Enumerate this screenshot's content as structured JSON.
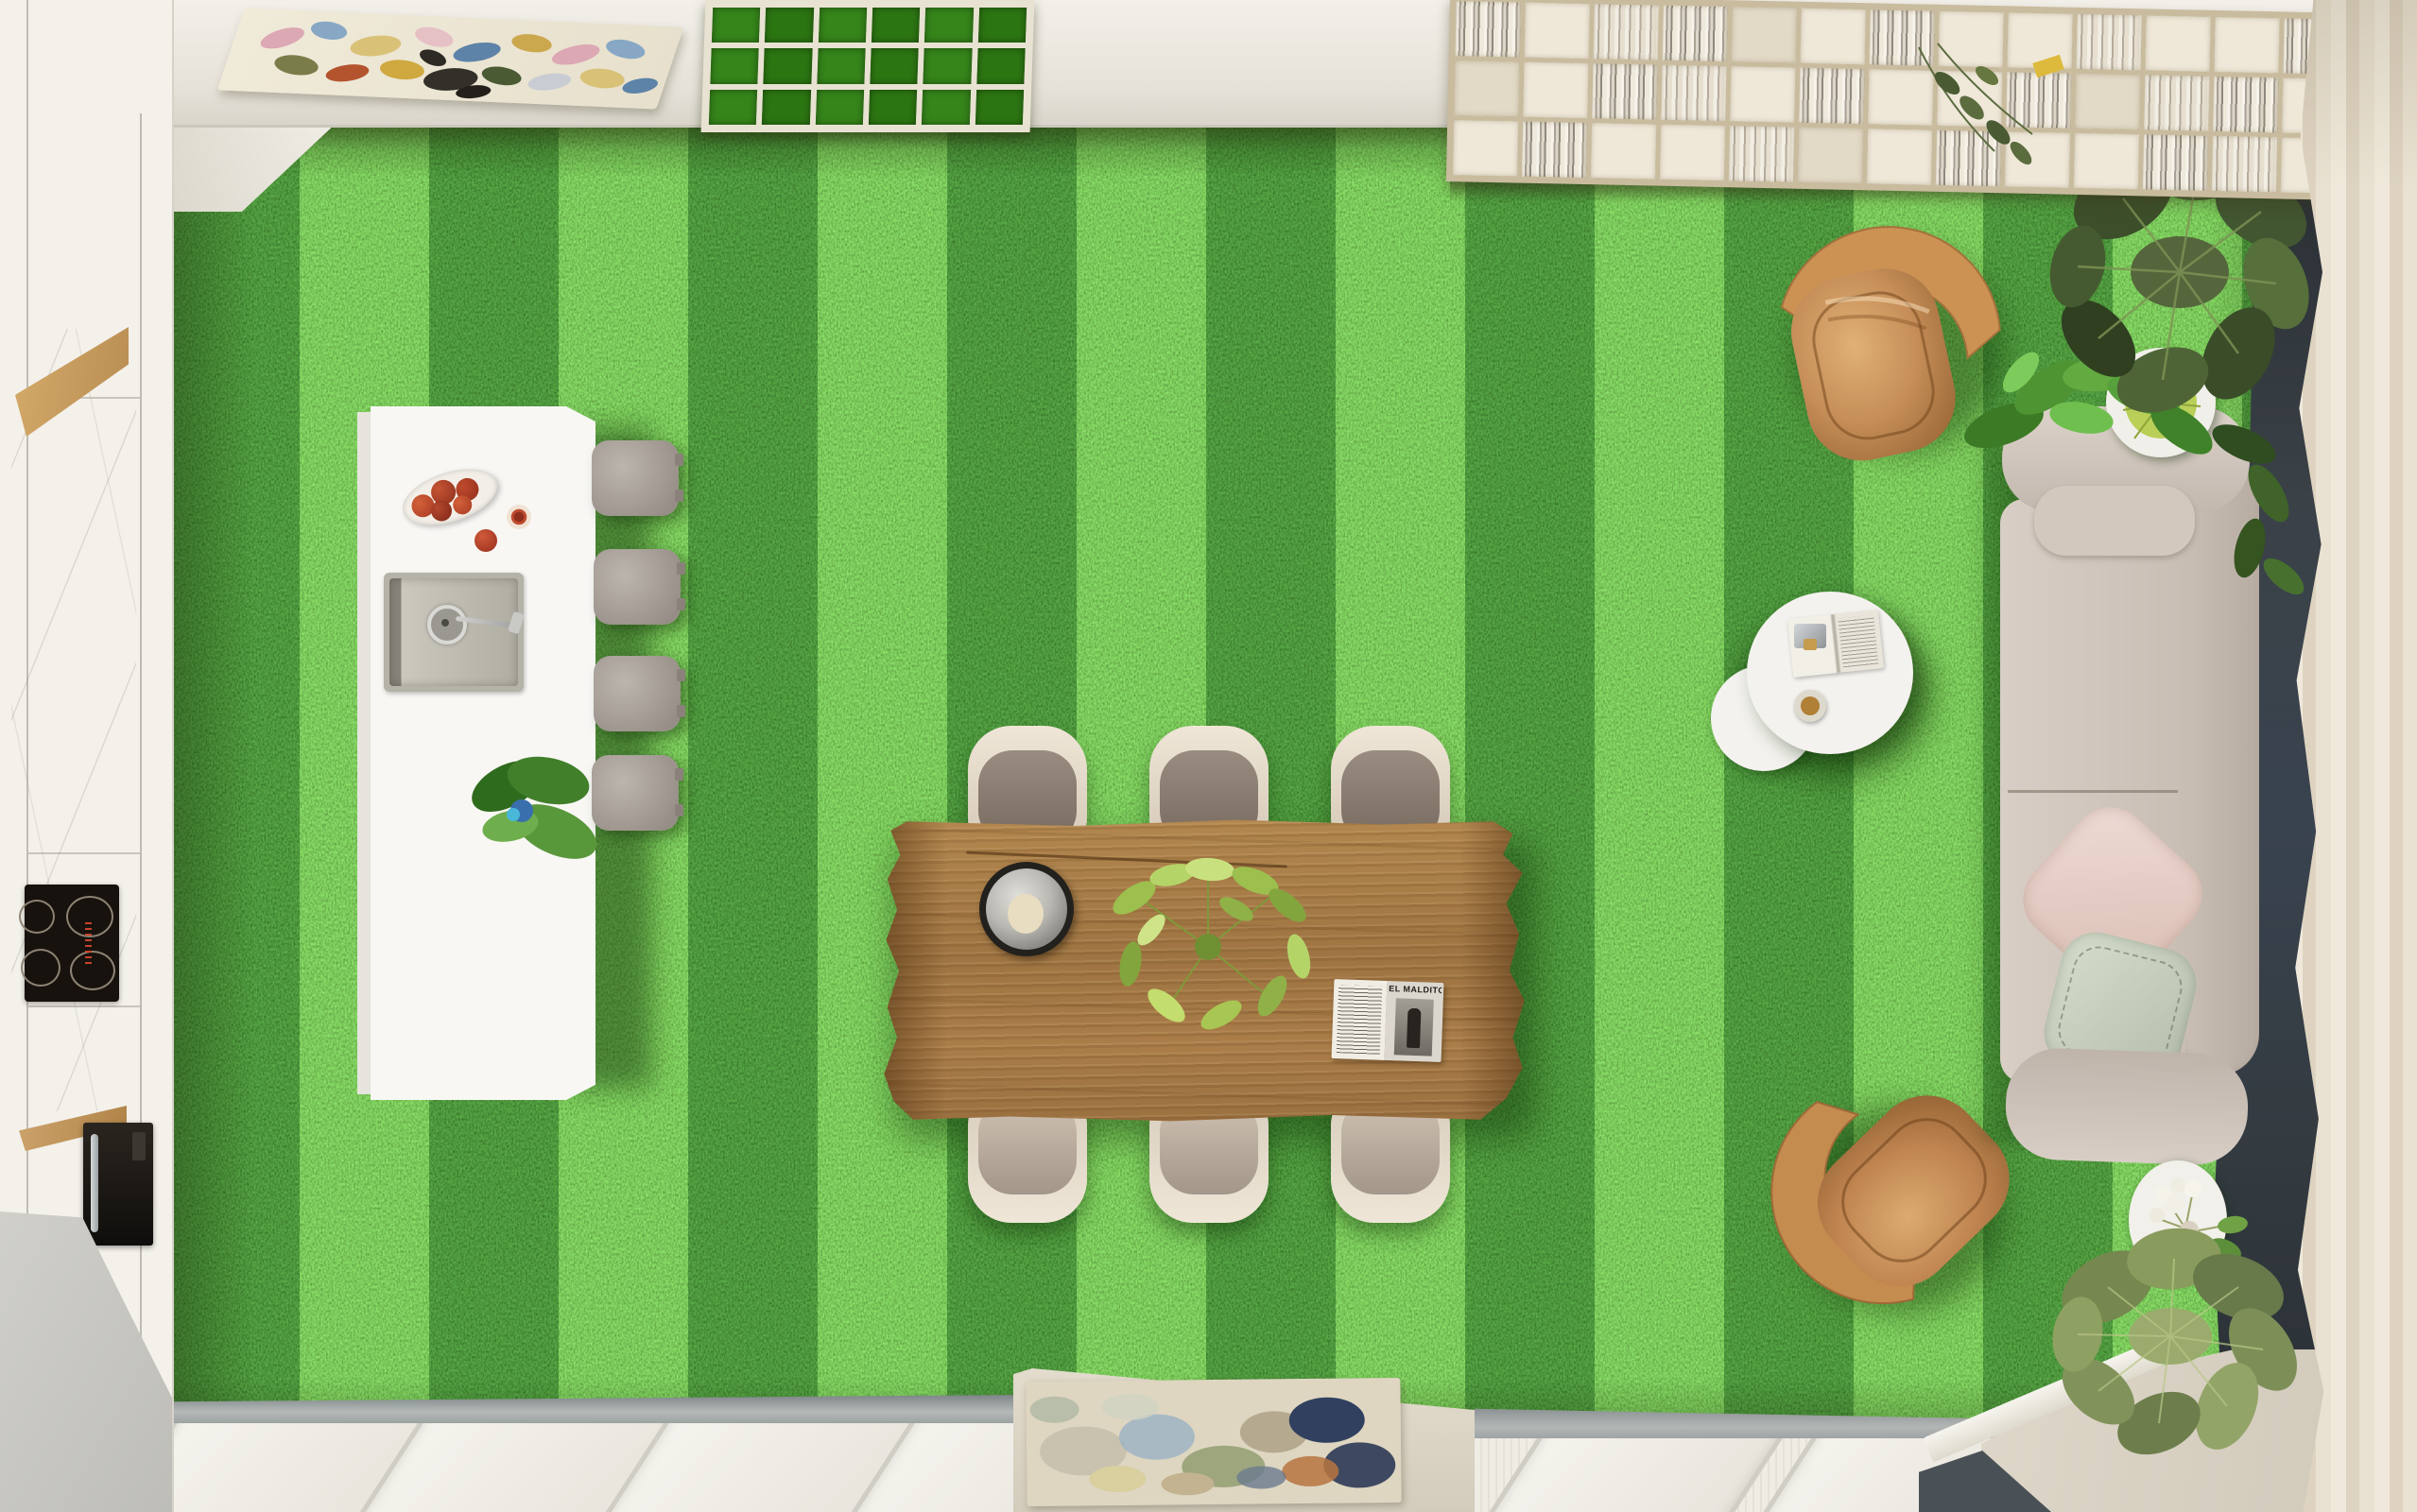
{
  "scene": {
    "title": "Top-down 3D render: open-plan living-dining room with striped grass floor",
    "view": "bird's-eye top-down",
    "floor": "green artificial lawn with mowing stripes"
  },
  "palette": {
    "grass_base": "#3e9718",
    "grass_dark_stripe": "#2f7d13",
    "grass_light_stripe": "#63c32d",
    "wall": "#f3f0ea",
    "marble": "#f6f5f2",
    "wood_table": "#a87c49",
    "leather_armchair": "#c68e58",
    "sofa_fabric": "#d2c8bf",
    "pillow_blush": "#e7d3cc",
    "pillow_sage": "#c6cdbc",
    "curtain": "#ebe3d4",
    "dark_panel": "#343b41",
    "floor_beige": "#d8d1c4",
    "floor_gray": "#c9c8c3"
  },
  "kitchen": {
    "stool_count": 4,
    "cooktop_burner_count": 4,
    "island_items": [
      "fruit dish",
      "cut pomegranate",
      "whole pomegranate",
      "sink with faucet",
      "monstera in blue pot"
    ]
  },
  "dining": {
    "chair_count": 6,
    "table_items": [
      "round metal tray",
      "green centerpiece plant",
      "open magazine"
    ],
    "magazine_title": "EL MALDITO"
  },
  "living": {
    "armchair_count": 2,
    "sofa_sections": [
      "top armrest",
      "headrest cushion",
      "backrest",
      "two seat cushions",
      "bottom armrest"
    ],
    "coffee_table_items": [
      "open book",
      "card holder",
      "espresso cup"
    ]
  },
  "decor": {
    "ceiling_art": "abstract multicolor painting",
    "rug_art": "abstract paint-splash rug",
    "plants": [
      "fiddle-leaf fig top-right",
      "monstera behind sofa",
      "twig-ball on side table",
      "white flowers on side table",
      "fiddle-leaf fig bottom-right"
    ]
  }
}
